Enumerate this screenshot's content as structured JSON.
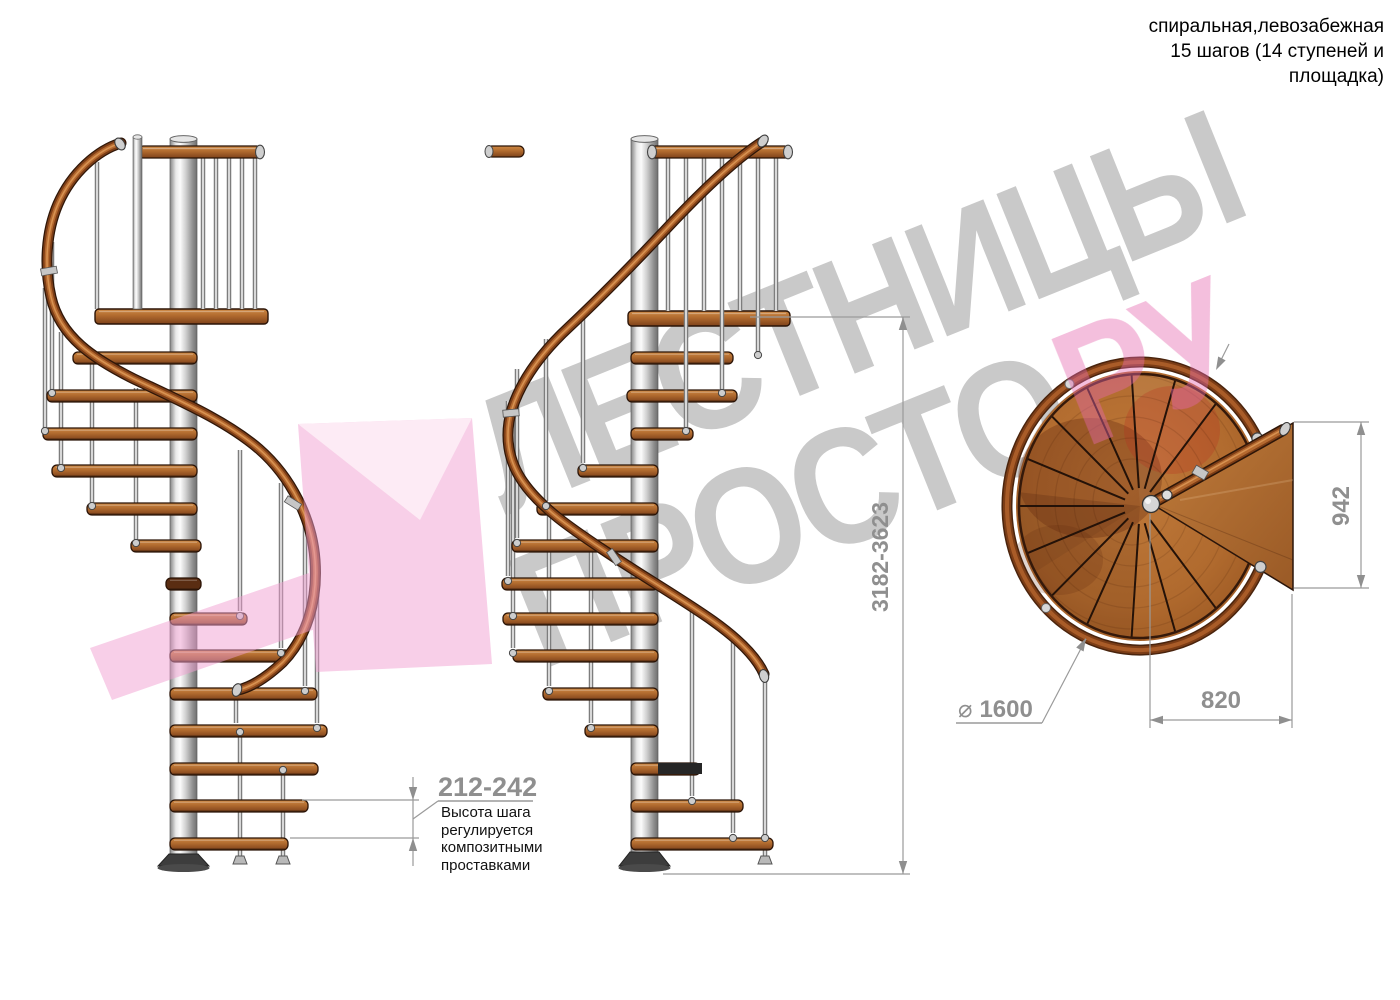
{
  "title_block": {
    "line1": "спиральная,левозабежная",
    "line2": "15 шагов (14 ступеней и",
    "line3": "площадка)"
  },
  "dimensions": {
    "step_height": "212-242",
    "total_height": "3182-3623",
    "platform_depth": "942",
    "platform_width": "820",
    "diameter_symbol": "⌀",
    "diameter_value": "1600"
  },
  "step_note": {
    "line1": "Высота шага",
    "line2": "регулируется",
    "line3": "композитными",
    "line4": "проставками"
  },
  "watermark": {
    "line1": "ЛЕСТНИЦЫ",
    "line2": "ПРОСТО",
    "suffix": "РУ"
  },
  "colors": {
    "wood": "#b06a2e",
    "handrail": "#7c3d16",
    "pole_gray": "#cccccc",
    "dimension_gray": "#8f8f8f",
    "watermark_gray": "#c9c9c9",
    "watermark_pink": "#e569ae",
    "text_black": "#111111"
  }
}
